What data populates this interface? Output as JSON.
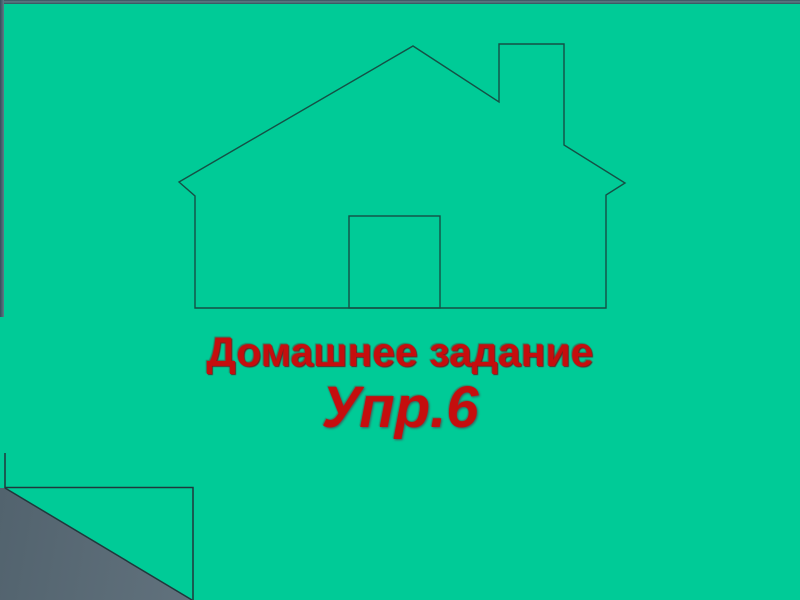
{
  "slide": {
    "kind": "presentation-slide",
    "title": "Домашнее задание",
    "exercise": "Упр.6"
  },
  "drawing": {
    "name": "house-outline",
    "description": "thin-line outline drawing of a house with chimney and door"
  },
  "colors": {
    "slide_background": "#00CB97",
    "title_red": "#C50E0E",
    "drawing_line": "#155045",
    "fold_line": "#20383C",
    "backdrop_dark": "#4C5D68",
    "backdrop_light": "#8998A4",
    "frame_edge_dark": "#33505C",
    "frame_edge_light": "#5F7A85"
  }
}
